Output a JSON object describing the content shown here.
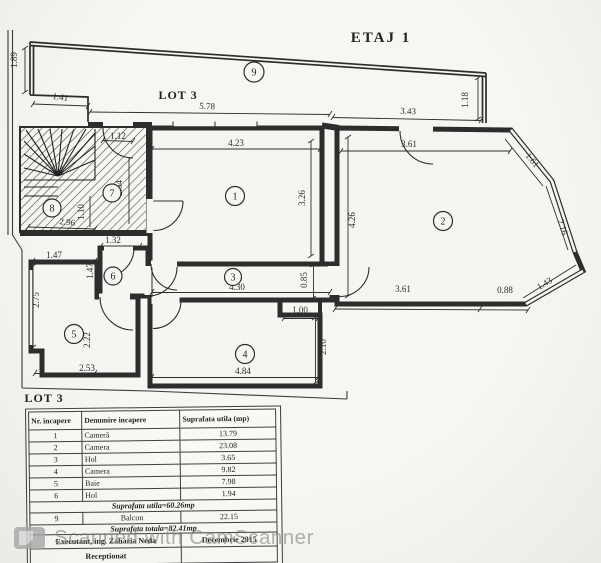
{
  "title": "ETAJ 1",
  "plan": {
    "lot_top": "LOT 3",
    "lot_bottom": "LOT 3",
    "rooms": [
      {
        "num": "1"
      },
      {
        "num": "2"
      },
      {
        "num": "3"
      },
      {
        "num": "4"
      },
      {
        "num": "5"
      },
      {
        "num": "6"
      },
      {
        "num": "7"
      },
      {
        "num": "8"
      },
      {
        "num": "9"
      }
    ],
    "dims": {
      "balcony_left": "1.89",
      "balcony_step": "1.41",
      "balcony_width": "5.78",
      "balcony_right_width": "3.43",
      "balcony_right_height": "1.18",
      "entry_door": "1.12",
      "stairs_right": "2.64",
      "stairs_inner": "1.10",
      "stairs_bottom": "2.96",
      "room1_width": "4.23",
      "room1_height": "3.26",
      "room2_entry": "3.61",
      "room2_left": "4.26",
      "bay_top": "1.61",
      "bay_mid": "2.16",
      "bay_bottom": "1.43",
      "room2_bottom": "3.61",
      "room2_bottom_small": "0.88",
      "hall_width": "4.30",
      "hall_height": "0.85",
      "room4_width": "4.84",
      "room4_height": "2.10",
      "room4_notch": "1.00",
      "room5_top": "1.47",
      "room5_left": "2.75",
      "room5_inner": "2.22",
      "room5_bottom": "2.53",
      "room6_top": "1.32",
      "room6_left": "1.47"
    }
  },
  "table": {
    "headers": [
      "Nr. incapere",
      "Denumire incapere",
      "Suprafata utila (mp)"
    ],
    "rows": [
      {
        "nr": "1",
        "name": "Cameră",
        "area": "13.79"
      },
      {
        "nr": "2",
        "name": "Camera",
        "area": "23.08"
      },
      {
        "nr": "3",
        "name": "Hol",
        "area": "3.65"
      },
      {
        "nr": "4",
        "name": "Camera",
        "area": "9.82"
      },
      {
        "nr": "5",
        "name": "Baie",
        "area": "7.98"
      },
      {
        "nr": "6",
        "name": "Hol",
        "area": "1.94"
      }
    ],
    "subtotal": "Suprafata utila=60.26mp",
    "balcony_row": {
      "nr": "9",
      "name": "Balcon",
      "area": "22.15"
    },
    "total": "Suprafata totala=82.41mp",
    "executant": "Executant, ing. Zaharia Neda",
    "date": "Decembrie 2015",
    "received": "Receptionat"
  },
  "watermark": {
    "text": "Scanned with CamScanner"
  }
}
